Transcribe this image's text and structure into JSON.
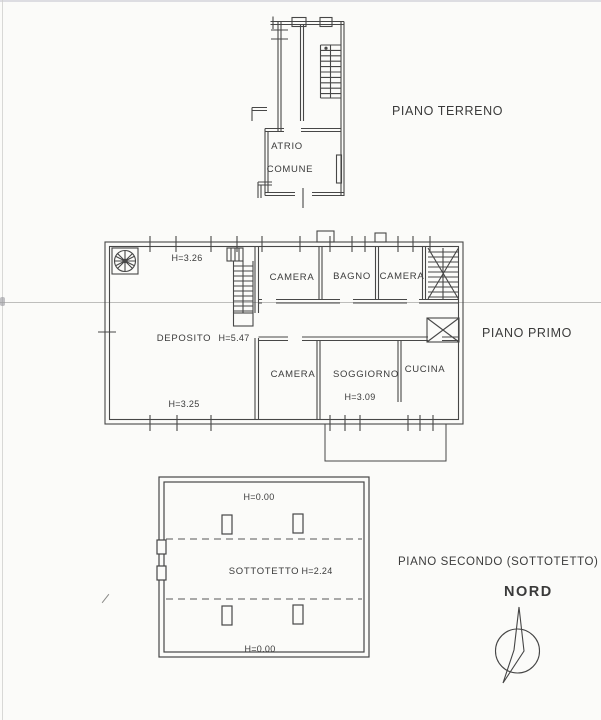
{
  "page": {
    "paper_color": "#fbfbf9",
    "ink_color": "#3c3c3c"
  },
  "floors": {
    "ground": {
      "title": "PIANO TERRENO",
      "atrio_line1": "ATRIO",
      "atrio_line2": "COMUNE"
    },
    "first": {
      "title": "PIANO PRIMO",
      "h_top": "H=3.26",
      "camera_top": "CAMERA",
      "bagno": "BAGNO",
      "camera_top_right": "CAMERA",
      "deposito": "DEPOSITO",
      "deposito_h": "H=5.47",
      "camera_bottom": "CAMERA",
      "soggiorno": "SOGGIORNO",
      "soggiorno_h": "H=3.09",
      "cucina": "CUCINA",
      "h_bottom": "H=3.25"
    },
    "second": {
      "title": "PIANO SECONDO (SOTTOTETTO)",
      "h_top": "H=0.00",
      "room": "SOTTOTETTO",
      "room_h": "H=2.24",
      "h_bottom": "H=0.00"
    }
  },
  "compass": {
    "label": "NORD"
  }
}
